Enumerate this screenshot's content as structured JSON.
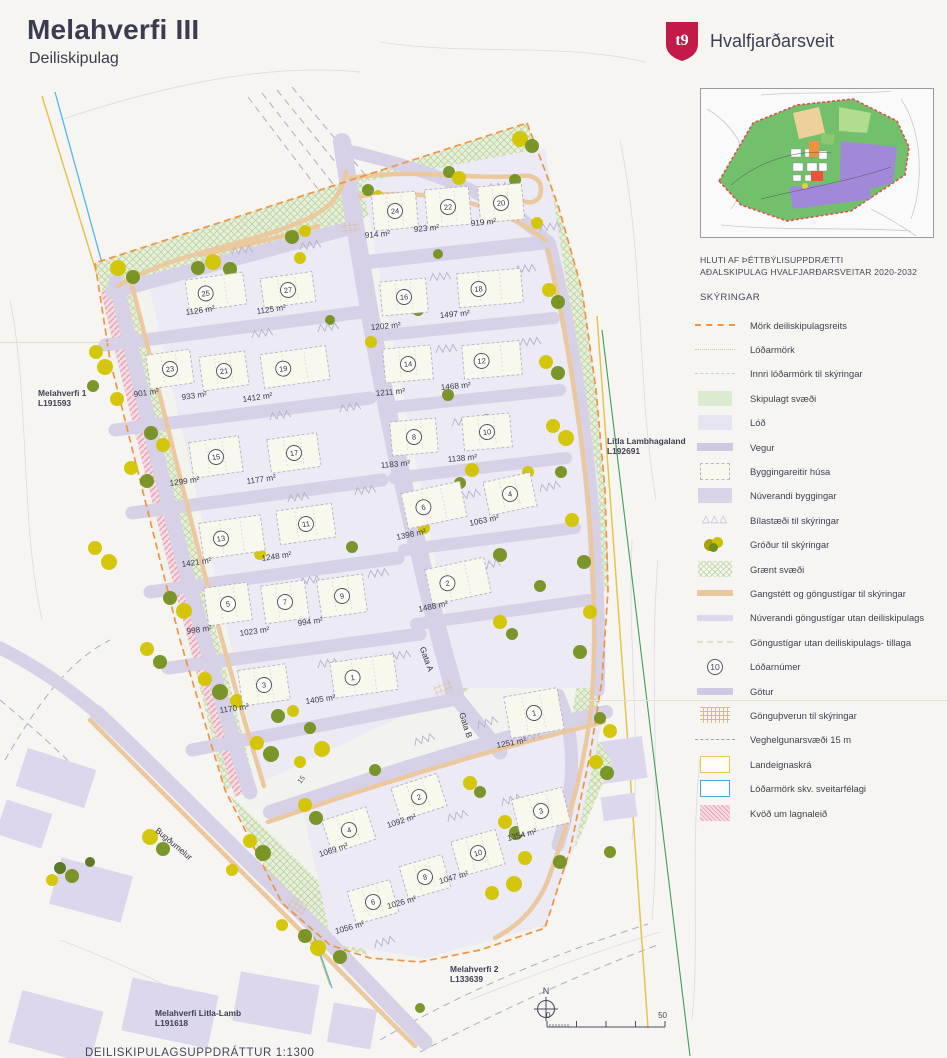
{
  "header": {
    "title": "Melahverfi III",
    "subtitle": "Deiliskipulag",
    "municipality": "Hvalfjarðarsveit"
  },
  "inset": {
    "caption_line1": "HLUTI AF ÞÉTTBÝLISUPPDRÆTTI",
    "caption_line2": "AÐALSKIPULAG HVALFJARÐARSVEITAR 2020-2032"
  },
  "legend": {
    "heading": "SKÝRINGAR",
    "items": [
      {
        "sym": "dash-orange",
        "label": "Mörk deiliskipulagsreits"
      },
      {
        "sym": "dot-faint",
        "label": "Lóðarmörk"
      },
      {
        "sym": "dash-faint",
        "label": "Innri lóðarmörk til skýringar"
      },
      {
        "sym": "fill-green",
        "label": "Skipulagt svæði"
      },
      {
        "sym": "fill-lod",
        "label": "Lóð"
      },
      {
        "sym": "bar-vegur",
        "label": "Vegur"
      },
      {
        "sym": "bldg",
        "label": "Byggingareitir húsa"
      },
      {
        "sym": "fill-nuv",
        "label": "Núverandi byggingar"
      },
      {
        "sym": "tri",
        "label": "Bílastæði til skýringar",
        "glyph": "△△△"
      },
      {
        "sym": "trees",
        "label": "Gróður til skýringar"
      },
      {
        "sym": "hatch-green",
        "label": "Grænt svæði"
      },
      {
        "sym": "bar-tan",
        "label": "Gangstétt og göngustígar til skýringar"
      },
      {
        "sym": "bar-lav",
        "label": "Núverandi göngustígar utan deiliskipulags"
      },
      {
        "sym": "dash-cream",
        "label": "Göngustígar utan deiliskipulags- tillaga"
      },
      {
        "sym": "circle-num",
        "label": "Lóðarnúmer",
        "badge": "10"
      },
      {
        "sym": "bar-gotur",
        "label": "Götur"
      },
      {
        "sym": "grid-tan",
        "label": "Gönguþverun til skýringar"
      },
      {
        "sym": "dash-veg",
        "label": "Veghelgunarsvæði 15 m"
      },
      {
        "sym": "rect-yellow",
        "label": "Landeignaskrá"
      },
      {
        "sym": "rect-blue",
        "label": "Lóðarmörk skv. sveitarfélagi"
      },
      {
        "sym": "hatch-pink",
        "label": "Kvöð um lagnaleið"
      }
    ]
  },
  "map": {
    "lots": [
      {
        "n": "24",
        "area": "914 m²",
        "x": 395,
        "y": 211,
        "r": -5,
        "w": 44,
        "h": 36,
        "ax": 365,
        "ay": 238
      },
      {
        "n": "22",
        "area": "923 m²",
        "x": 448,
        "y": 207,
        "r": -5,
        "w": 44,
        "h": 38,
        "ax": 414,
        "ay": 232
      },
      {
        "n": "20",
        "area": "919 m²",
        "x": 501,
        "y": 203,
        "r": -5,
        "w": 44,
        "h": 36,
        "ax": 471,
        "ay": 226
      },
      {
        "n": "16",
        "area": "1202 m²",
        "x": 404,
        "y": 297,
        "r": -5,
        "w": 46,
        "h": 34,
        "ax": 371,
        "ay": 330
      },
      {
        "n": "18",
        "area": "1497 m²",
        "x": 490,
        "y": 288,
        "r": -5,
        "w": 64,
        "h": 34,
        "ax": 440,
        "ay": 318
      },
      {
        "n": "14",
        "area": "1211 m²",
        "x": 408,
        "y": 364,
        "r": -5,
        "w": 48,
        "h": 34,
        "ax": 376,
        "ay": 396
      },
      {
        "n": "12",
        "area": "1468 m²",
        "x": 492,
        "y": 360,
        "r": -5,
        "w": 58,
        "h": 34,
        "ax": 441,
        "ay": 390
      },
      {
        "n": "8",
        "area": "1183 m²",
        "x": 414,
        "y": 437,
        "r": -5,
        "w": 46,
        "h": 34,
        "ax": 381,
        "ay": 468
      },
      {
        "n": "10",
        "area": "1138 m²",
        "x": 487,
        "y": 432,
        "r": -5,
        "w": 48,
        "h": 34,
        "ax": 448,
        "ay": 462
      },
      {
        "n": "6",
        "area": "1398 m²",
        "x": 434,
        "y": 505,
        "r": -12,
        "w": 60,
        "h": 36,
        "ax": 397,
        "ay": 540
      },
      {
        "n": "4",
        "area": "1063 m²",
        "x": 510,
        "y": 494,
        "r": -12,
        "w": 48,
        "h": 34,
        "ax": 470,
        "ay": 526
      },
      {
        "n": "2",
        "area": "1488 m²",
        "x": 458,
        "y": 581,
        "r": -12,
        "w": 60,
        "h": 36,
        "ax": 419,
        "ay": 612
      },
      {
        "n": "25",
        "area": "1126 m²",
        "x": 216,
        "y": 292,
        "r": -8,
        "w": 58,
        "h": 32,
        "ax": 186,
        "ay": 315
      },
      {
        "n": "27",
        "area": "1125 m²",
        "x": 288,
        "y": 290,
        "r": -8,
        "w": 52,
        "h": 30,
        "ax": 257,
        "ay": 314
      },
      {
        "n": "23",
        "area": "901 m²",
        "x": 170,
        "y": 369,
        "r": -8,
        "w": 44,
        "h": 34,
        "ax": 134,
        "ay": 397
      },
      {
        "n": "21",
        "area": "933 m²",
        "x": 224,
        "y": 371,
        "r": -8,
        "w": 46,
        "h": 34,
        "ax": 182,
        "ay": 400
      },
      {
        "n": "19",
        "area": "1412 m²",
        "x": 295,
        "y": 367,
        "r": -8,
        "w": 66,
        "h": 34,
        "ax": 243,
        "ay": 402
      },
      {
        "n": "15",
        "area": "1299 m²",
        "x": 216,
        "y": 457,
        "r": -8,
        "w": 50,
        "h": 36,
        "ax": 170,
        "ay": 486
      },
      {
        "n": "17",
        "area": "1177 m²",
        "x": 294,
        "y": 453,
        "r": -8,
        "w": 50,
        "h": 34,
        "ax": 247,
        "ay": 484
      },
      {
        "n": "13",
        "area": "1421 m²",
        "x": 232,
        "y": 537,
        "r": -8,
        "w": 62,
        "h": 36,
        "ax": 182,
        "ay": 567
      },
      {
        "n": "11",
        "area": "1248 m²",
        "x": 306,
        "y": 524,
        "r": -8,
        "w": 56,
        "h": 34,
        "ax": 262,
        "ay": 561
      },
      {
        "n": "5",
        "area": "998 m²",
        "x": 228,
        "y": 604,
        "r": -8,
        "w": 44,
        "h": 38,
        "ax": 187,
        "ay": 634
      },
      {
        "n": "7",
        "area": "1023 m²",
        "x": 285,
        "y": 602,
        "r": -8,
        "w": 44,
        "h": 38,
        "ax": 240,
        "ay": 636
      },
      {
        "n": "9",
        "area": "994 m²",
        "x": 342,
        "y": 596,
        "r": -8,
        "w": 46,
        "h": 38,
        "ax": 298,
        "ay": 626
      },
      {
        "n": "3",
        "area": "1170 m²",
        "x": 264,
        "y": 685,
        "r": -8,
        "w": 48,
        "h": 36,
        "ax": 220,
        "ay": 713
      },
      {
        "n": "1",
        "area": "1405 m²",
        "x": 364,
        "y": 676,
        "r": -8,
        "w": 64,
        "h": 36,
        "ax": 306,
        "ay": 704
      },
      {
        "n": "1",
        "area": "1251 m²",
        "x": 534,
        "y": 713,
        "r": -10,
        "w": 54,
        "h": 42,
        "ax": 497,
        "ay": 748
      },
      {
        "n": "2",
        "area": "1092 m²",
        "x": 419,
        "y": 797,
        "r": -18,
        "w": 48,
        "h": 34,
        "ax": 388,
        "ay": 828
      },
      {
        "n": "4",
        "area": "1069 m²",
        "x": 349,
        "y": 830,
        "r": -18,
        "w": 46,
        "h": 34,
        "ax": 320,
        "ay": 857
      },
      {
        "n": "3",
        "area": "1354 m²",
        "x": 541,
        "y": 811,
        "r": -14,
        "w": 52,
        "h": 36,
        "ax": 508,
        "ay": 841
      },
      {
        "n": "10",
        "area": "1047 m²",
        "x": 478,
        "y": 853,
        "r": -16,
        "w": 46,
        "h": 36,
        "ax": 440,
        "ay": 884
      },
      {
        "n": "8",
        "area": "1026 m²",
        "x": 425,
        "y": 877,
        "r": -16,
        "w": 44,
        "h": 34,
        "ax": 388,
        "ay": 909
      },
      {
        "n": "6",
        "area": "1056 m²",
        "x": 373,
        "y": 902,
        "r": -16,
        "w": 44,
        "h": 34,
        "ax": 336,
        "ay": 934
      }
    ],
    "parcels": [
      {
        "name": "Melahverfi 1",
        "lnr": "L191593",
        "x": 38,
        "y": 396
      },
      {
        "name": "Litla Lambhagaland",
        "lnr": "L192691",
        "x": 607,
        "y": 444
      },
      {
        "name": "Melahverfi 2",
        "lnr": "L133639",
        "x": 450,
        "y": 972
      },
      {
        "name": "Melahverfi Litla-Lamb",
        "lnr": "L191618",
        "x": 155,
        "y": 1016
      }
    ],
    "streets": [
      {
        "name": "Gata A",
        "x": 424,
        "y": 660,
        "rot": 70
      },
      {
        "name": "Gata B",
        "x": 463,
        "y": 726,
        "rot": 72
      },
      {
        "name": "Bugðumelur",
        "x": 172,
        "y": 846,
        "rot": 40
      }
    ],
    "annotations": [
      {
        "text": "15",
        "x": 303,
        "y": 781,
        "rot": -52
      }
    ],
    "north": {
      "label": "N",
      "x": 546,
      "y": 1009
    },
    "scalebar": {
      "x": 547,
      "y": 1027,
      "width": 118,
      "from": "0",
      "to": "50"
    }
  },
  "footer": {
    "note": "DEILISKIPULAGSUPPDRÁTTUR  1:1300"
  },
  "colors": {
    "boundary_dash": "#ef9440",
    "road": "#d6d1e6",
    "lot_field": "#eceaf4",
    "building": "#f9f8ec",
    "green_area": "#e4eed7",
    "path_tan": "#ebc89e",
    "tree_yellow": "#d3c400",
    "tree_olive": "#74901e",
    "tree_dark": "#53731c",
    "pink_hatch": "#eb9fb2",
    "logo_red": "#c41a4a",
    "blue_line": "#53b7e8",
    "yellow_line": "#e4c44f"
  }
}
